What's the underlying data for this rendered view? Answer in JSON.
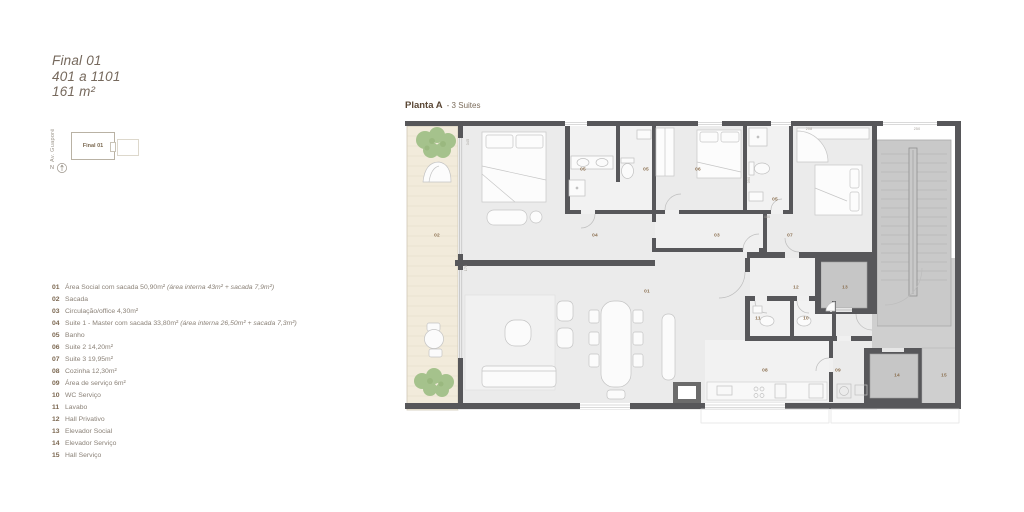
{
  "header": {
    "title": "Final 01",
    "subtitle": "401 a 1101",
    "area": "161 m²"
  },
  "keyplan": {
    "street": "Av. Guaporé",
    "unit": "Final 01",
    "north": "N"
  },
  "plan": {
    "title": "Planta A",
    "subtitle": "- 3 Suites"
  },
  "legend": {
    "items": [
      {
        "num": "01",
        "text": "Área Social com sacada 50,90m² ",
        "note": "(área interna 43m² + sacada 7,9m²)"
      },
      {
        "num": "02",
        "text": "Sacada",
        "note": ""
      },
      {
        "num": "03",
        "text": "Circulação/office 4,30m²",
        "note": ""
      },
      {
        "num": "04",
        "text": "Suite 1 - Master com sacada 33,80m² ",
        "note": "(área interna 26,50m² + sacada 7,3m²)"
      },
      {
        "num": "05",
        "text": "Banho",
        "note": ""
      },
      {
        "num": "06",
        "text": "Suite 2 14,20m²",
        "note": ""
      },
      {
        "num": "07",
        "text": "Suite 3 19,95m²",
        "note": ""
      },
      {
        "num": "08",
        "text": "Cozinha 12,30m²",
        "note": ""
      },
      {
        "num": "09",
        "text": "Área de serviço 6m²",
        "note": ""
      },
      {
        "num": "10",
        "text": "WC Serviço",
        "note": ""
      },
      {
        "num": "11",
        "text": "Lavabo",
        "note": ""
      },
      {
        "num": "12",
        "text": "Hall Privativo",
        "note": ""
      },
      {
        "num": "13",
        "text": "Elevador Social",
        "note": ""
      },
      {
        "num": "14",
        "text": "Elevador Serviço",
        "note": ""
      },
      {
        "num": "15",
        "text": "Hall Serviço",
        "note": ""
      }
    ]
  },
  "plan_labels": {
    "area_social": "01",
    "sacada": "02",
    "circulacao": "03",
    "suite1": "04",
    "banho_a": "05",
    "banho_b": "05",
    "banho_c": "05",
    "suite2": "06",
    "suite3": "07",
    "cozinha": "08",
    "servico": "09",
    "wc": "10",
    "lavabo": "11",
    "hall_priv": "12",
    "elev_social": "13",
    "elev_serv": "14",
    "hall_serv": "15"
  },
  "dims": {
    "d1": "345",
    "d2": "250",
    "d3": "208",
    "d4": "480",
    "d5": "170",
    "d6": "090"
  },
  "colors": {
    "wall": "#57575a",
    "floor": "#ebebeb",
    "common_gray": "#cbcbcb",
    "balcony": "#f2ebdb",
    "plant_green": "#a5c28c",
    "accent_text": "#7b6750",
    "body_text": "#8b8278",
    "title_text": "#76695d"
  }
}
